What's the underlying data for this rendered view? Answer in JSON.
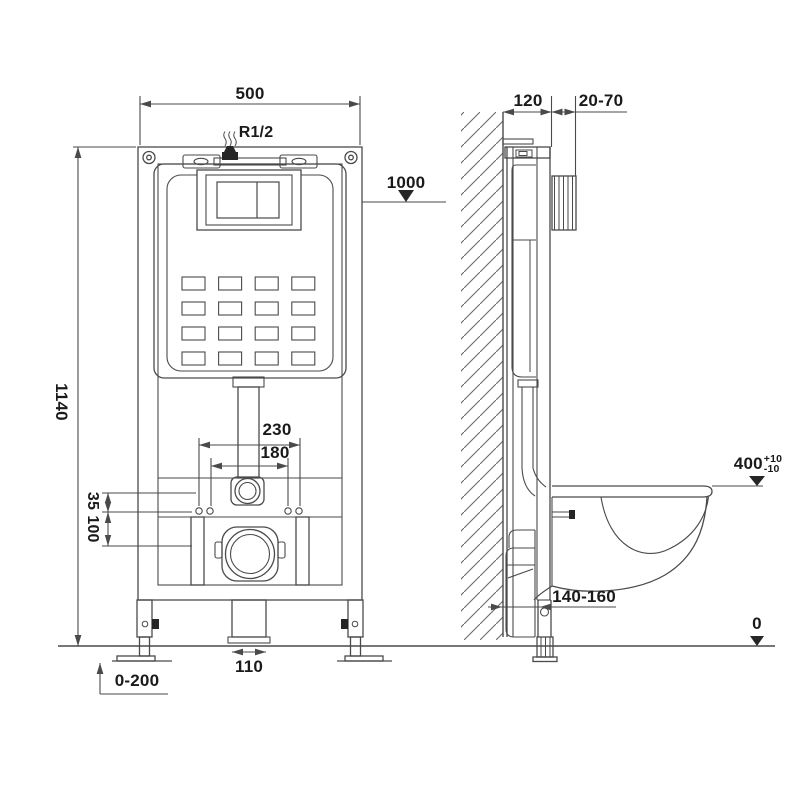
{
  "drawing": {
    "type": "technical installation drawing",
    "subject": "concealed cistern wall-hung toilet frame, front and side view",
    "units_note": "mm"
  },
  "front_view": {
    "width": "500",
    "inlet": "R1/2",
    "install_height": "1000",
    "frame_height": "1140",
    "fixing_span_outer": "230",
    "fixing_span_inner": "180",
    "offset_small": "35",
    "offset_large": "100",
    "drain_width": "110",
    "leg_adjustment": "0-200"
  },
  "side_view": {
    "frame_depth": "120",
    "wall_finish": "20-70",
    "bowl_height": "400",
    "bowl_height_plus": "+10",
    "bowl_height_minus": "-10",
    "drain_distance": "140-160",
    "floor_level": "0"
  },
  "colors": {
    "line": "#4a4a4a",
    "text": "#1a1a1a",
    "dark_fill": "#262626",
    "background": "#ffffff"
  }
}
